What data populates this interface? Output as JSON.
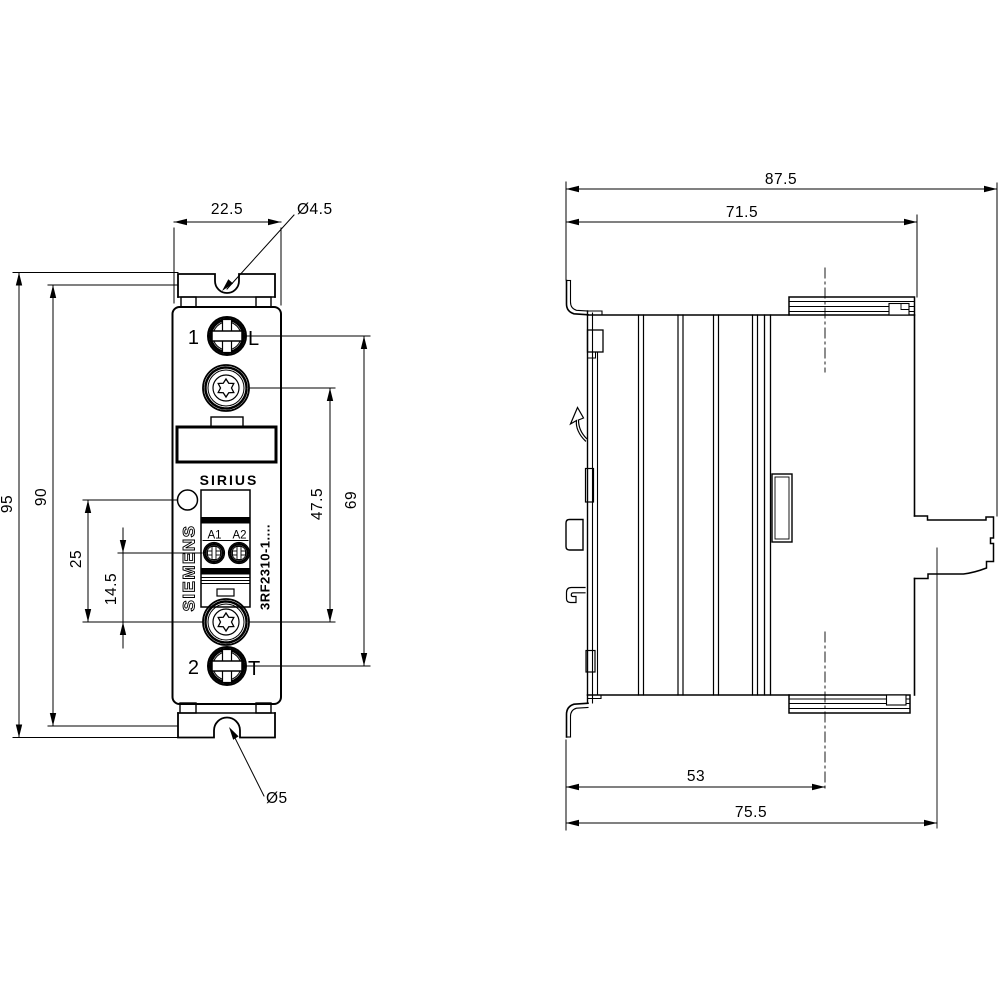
{
  "meta": {
    "background": "#ffffff",
    "line_color": "#000000"
  },
  "front_view": {
    "brand": "SIEMENS",
    "product": "SIRIUS",
    "model": "3RF2310-1....",
    "terminals": {
      "top_number": "1",
      "top_tag": "L",
      "bottom_number": "2",
      "bottom_tag": "T",
      "coil_a1": "A1",
      "coil_a2": "A2"
    },
    "dims": {
      "width": "22.5",
      "hole_top": "Ø4.5",
      "overall_height": "95",
      "inner_height": "90",
      "led_offset": "25",
      "coil_offset": "14.5",
      "fixing_span": "47.5",
      "terminal_span": "69",
      "hole_bottom": "Ø5"
    }
  },
  "side_view": {
    "dims": {
      "overall_depth": "87.5",
      "body_depth": "71.5",
      "center_offset": "53",
      "terminal_depth": "75.5"
    }
  }
}
